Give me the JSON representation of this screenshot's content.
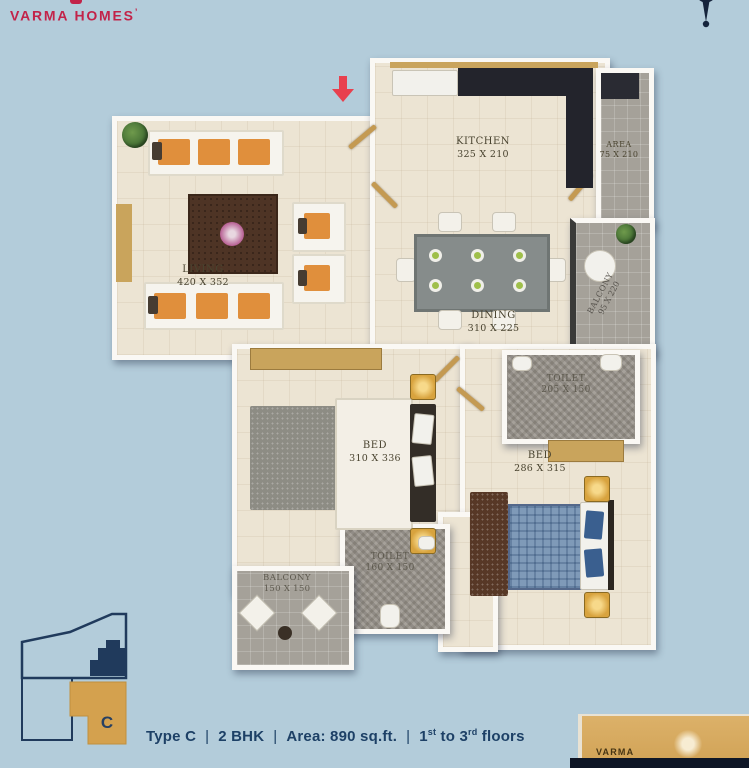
{
  "brand": {
    "logo_text": "VARMA HOMES",
    "logo_mark": "’"
  },
  "colors": {
    "background": "#b3ccda",
    "brand_red": "#c22349",
    "navy": "#1d4066",
    "unit_gold": "#d4a14e",
    "floor_cream": "#ece4d3",
    "wall_white": "#faf8f4",
    "counter_dark": "#23242c",
    "wood": "#c9a45c",
    "bed_blue": "#7f9ab8"
  },
  "plan": {
    "rooms": {
      "living": {
        "label": "LIVING",
        "dims": "420 X 352"
      },
      "kitchen": {
        "label": "KITCHEN",
        "dims": "325 X 210"
      },
      "work_area": {
        "label": "AREA",
        "dims": "75 X 210"
      },
      "dining": {
        "label": "DINING",
        "dims": "310 X 225"
      },
      "balcony_right": {
        "label": "BALCONY",
        "dims": "95 X 220"
      },
      "bed_1": {
        "label": "BED",
        "dims": "310 X 336"
      },
      "toilet_1": {
        "label": "TOILET",
        "dims": "205 X 150"
      },
      "bed_2": {
        "label": "BED",
        "dims": "286 X 315"
      },
      "toilet_2": {
        "label": "TOILET",
        "dims": "160 X 150"
      },
      "balcony_bottom": {
        "label": "BALCONY",
        "dims": "150 X 150"
      }
    }
  },
  "key_plan": {
    "unit_label": "C"
  },
  "footer": {
    "type": "Type C",
    "sep": "|",
    "bhk": "2 BHK",
    "area": "Area: 890 sq.ft.",
    "floors_pre": "1",
    "floors_sup1": "st",
    "floors_mid": " to 3",
    "floors_sup2": "rd",
    "floors_post": " floors"
  },
  "watermark": {
    "text": "VARMA"
  }
}
